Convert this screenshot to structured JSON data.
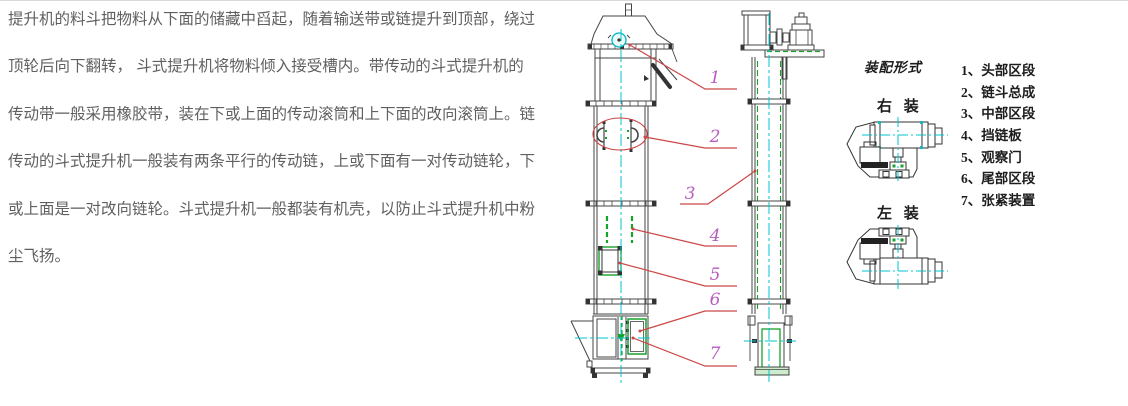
{
  "description": {
    "lines": [
      "提升机的料斗把物料从下面的储藏中舀起，随着输送带或链提升到顶部，绕过",
      "顶轮后向下翻转， 斗式提升机将物料倾入接受槽内。带传动的斗式提升机的",
      "传动带一般采用橡胶带，装在下或上面的传动滚筒和上下面的改向滚筒上。链",
      "传动的斗式提升机一般装有两条平行的传动链，上或下面有一对传动链轮，下",
      "或上面是一对改向链轮。斗式提升机一般都装有机壳，以防止斗式提升机中粉",
      "尘飞扬。"
    ]
  },
  "elevator_drawing": {
    "callout_labels": [
      "1",
      "2",
      "3",
      "4",
      "5",
      "6",
      "7"
    ],
    "colors": {
      "line": "#444444",
      "centerline": "#00c3cf",
      "highlight": "#17a32b",
      "leader": "#cc4747",
      "callout": "#b95cc0",
      "detail_ellipse": "#cc4040"
    }
  },
  "assembly_panel": {
    "title": "装配形式",
    "right_mount_label": "右 装",
    "left_mount_label": "左 装",
    "legend": [
      "1、头部区段",
      "2、链斗总成",
      "3、中部区段",
      "4、挡链板",
      "5、观察门",
      "6、尾部区段",
      "7、张紧装置"
    ]
  }
}
